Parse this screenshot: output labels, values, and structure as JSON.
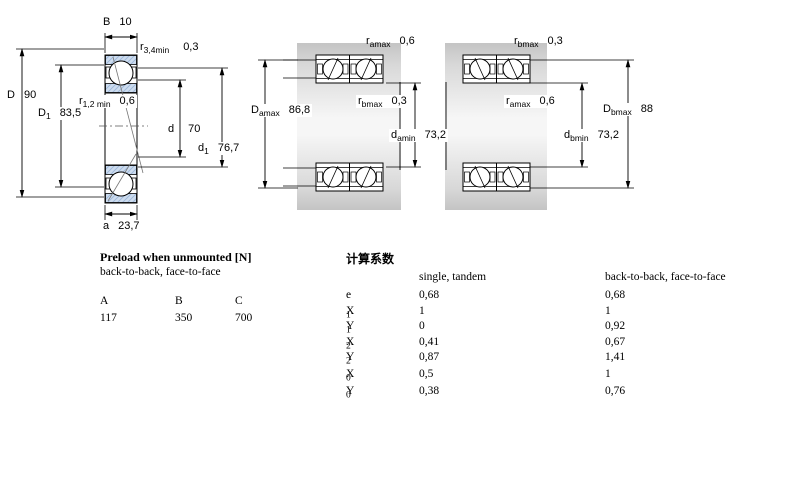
{
  "drawings": {
    "left": {
      "labels": {
        "B": {
          "base": "B",
          "sub": "",
          "value": "10"
        },
        "r34": {
          "base": "r",
          "sub": "3,4min",
          "value": "0,3"
        },
        "D": {
          "base": "D",
          "sub": "",
          "value": "90"
        },
        "D1": {
          "base": "D",
          "sub": "1",
          "value": "83,5"
        },
        "r12": {
          "base": "r",
          "sub": "1,2 min",
          "value": "0,6"
        },
        "d": {
          "base": "d",
          "sub": "",
          "value": "70"
        },
        "d1": {
          "base": "d",
          "sub": "1",
          "value": "76,7"
        },
        "a": {
          "base": "a",
          "sub": "",
          "value": "23,7"
        }
      }
    },
    "middle": {
      "labels": {
        "ramax": {
          "base": "r",
          "sub": "amax",
          "value": "0,6"
        },
        "rbmax": {
          "base": "r",
          "sub": "bmax",
          "value": "0,3"
        },
        "Damax": {
          "base": "D",
          "sub": "amax",
          "value": "86,8"
        },
        "damin": {
          "base": "d",
          "sub": "amin",
          "value": "73,2"
        }
      }
    },
    "right": {
      "labels": {
        "rbmax": {
          "base": "r",
          "sub": "bmax",
          "value": "0,3"
        },
        "ramax": {
          "base": "r",
          "sub": "amax",
          "value": "0,6"
        },
        "Dbmax": {
          "base": "D",
          "sub": "bmax",
          "value": "88"
        },
        "dbmin": {
          "base": "d",
          "sub": "bmin",
          "value": "73,2"
        }
      }
    }
  },
  "preload": {
    "title": "Preload when unmounted [N]",
    "subtitle": "back-to-back, face-to-face",
    "columns": [
      "A",
      "B",
      "C"
    ],
    "values": [
      "117",
      "350",
      "700"
    ]
  },
  "factors": {
    "title": "计算系数",
    "col1_header": "single, tandem",
    "col2_header": "back-to-back, face-to-face",
    "rows": [
      {
        "base": "e",
        "sub": "",
        "single": "0,68",
        "btb": "0,68"
      },
      {
        "base": "X",
        "sub": "1",
        "single": "1",
        "btb": "1"
      },
      {
        "base": "Y",
        "sub": "1",
        "single": "0",
        "btb": "0,92"
      },
      {
        "base": "X",
        "sub": "2",
        "single": "0,41",
        "btb": "0,67"
      },
      {
        "base": "Y",
        "sub": "2",
        "single": "0,87",
        "btb": "1,41"
      },
      {
        "base": "X",
        "sub": "0",
        "single": "0,5",
        "btb": "1"
      },
      {
        "base": "Y",
        "sub": "0",
        "single": "0,38",
        "btb": "0,76"
      }
    ]
  },
  "colors": {
    "hatch_fill": "#cddcee",
    "hatch_line": "#9db7d9",
    "housing_gray": "#c6c6c6",
    "line_black": "#000000"
  }
}
